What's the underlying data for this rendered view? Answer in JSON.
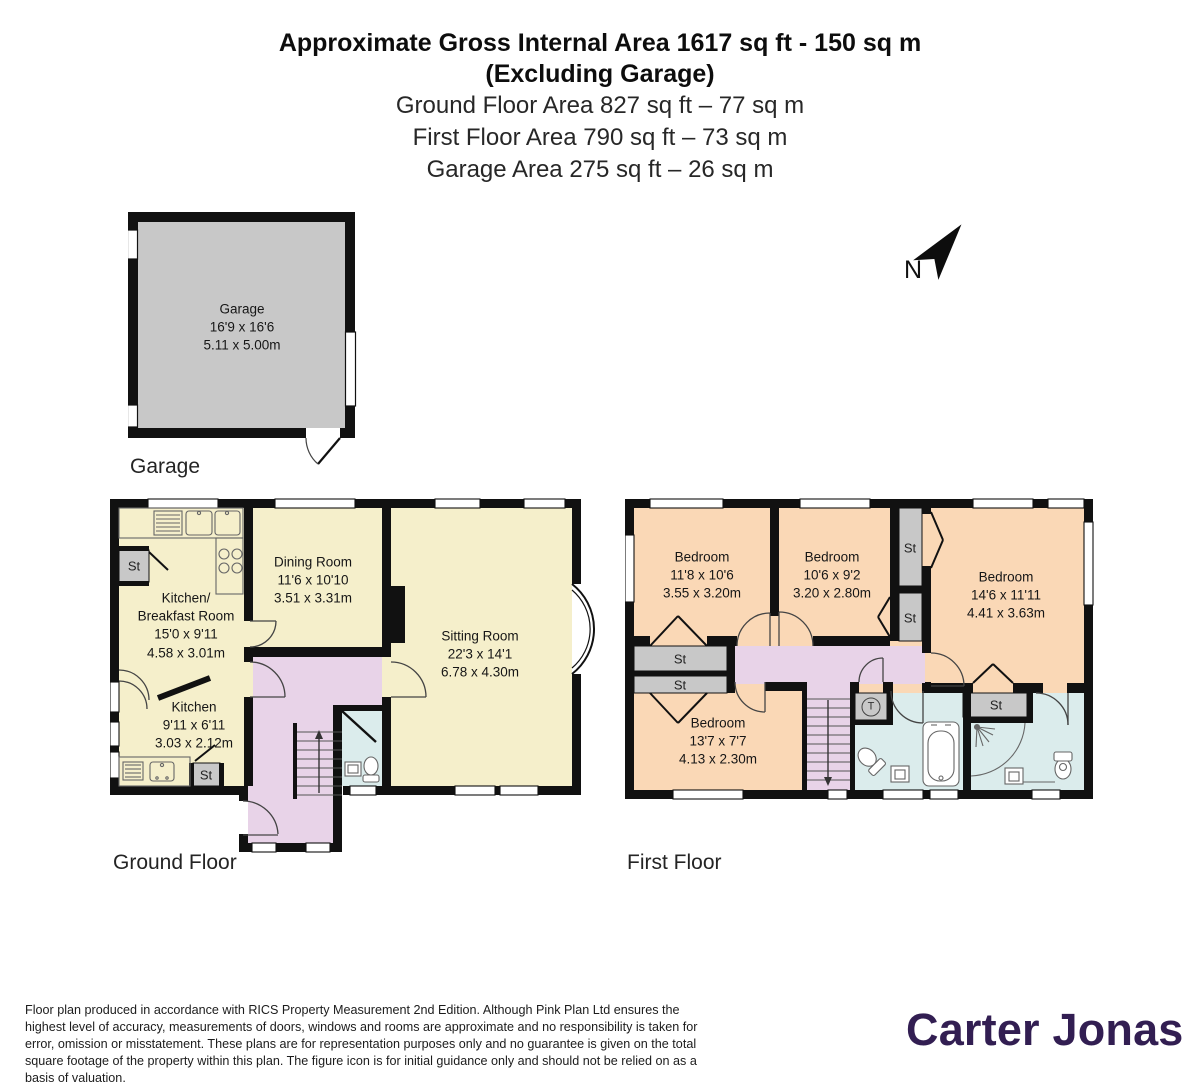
{
  "header": {
    "title_line1": "Approximate Gross Internal Area 1617 sq ft - 150 sq m",
    "title_line2": "(Excluding Garage)",
    "subtitle_lines": [
      "Ground Floor Area 827 sq ft – 77 sq m",
      "First Floor Area 790 sq ft – 73 sq m",
      "Garage Area 275 sq ft – 26 sq m"
    ]
  },
  "compass": {
    "label": "N"
  },
  "labels": {
    "storage": "St",
    "tank": "T"
  },
  "garage_plan": {
    "caption": "Garage",
    "room": {
      "name": "Garage",
      "imperial": "16'9 x 16'6",
      "metric": "5.11 x 5.00m"
    }
  },
  "ground_floor": {
    "caption": "Ground Floor",
    "rooms": {
      "kitchen_breakfast": {
        "name": "Kitchen/",
        "name2": "Breakfast Room",
        "imperial": "15'0 x 9'11",
        "metric": "4.58 x 3.01m"
      },
      "dining": {
        "name": "Dining Room",
        "imperial": "11'6 x 10'10",
        "metric": "3.51 x 3.31m"
      },
      "sitting": {
        "name": "Sitting Room",
        "imperial": "22'3 x 14'1",
        "metric": "6.78 x 4.30m"
      },
      "kitchen": {
        "name": "Kitchen",
        "imperial": "9'11 x 6'11",
        "metric": "3.03 x 2.12m"
      }
    }
  },
  "first_floor": {
    "caption": "First Floor",
    "rooms": {
      "bedroom1": {
        "name": "Bedroom",
        "imperial": "11'8 x 10'6",
        "metric": "3.55 x 3.20m"
      },
      "bedroom2": {
        "name": "Bedroom",
        "imperial": "10'6 x 9'2",
        "metric": "3.20 x 2.80m"
      },
      "bedroom3": {
        "name": "Bedroom",
        "imperial": "14'6 x 11'11",
        "metric": "4.41 x 3.63m"
      },
      "bedroom4": {
        "name": "Bedroom",
        "imperial": "13'7 x 7'7",
        "metric": "4.13 x 2.30m"
      }
    }
  },
  "footer": {
    "disclaimer": "Floor plan produced in accordance with RICS Property Measurement 2nd Edition. Although Pink Plan Ltd ensures the highest level of accuracy, measurements of doors, windows and rooms are approximate and no responsibility is taken for error, omission or misstatement. These plans are for representation purposes only and no guarantee is given on the total square footage of the property within this plan. The figure icon is for initial guidance only and should not be relied on as a basis of valuation.",
    "brand": "Carter Jonas"
  },
  "colors": {
    "room_yellow": "#f5efcb",
    "room_peach": "#fad8b6",
    "hall_pink": "#e8d3e8",
    "bath_blue": "#dbecec",
    "storage_gray": "#c8c8c8",
    "wall_black": "#111111",
    "brand_purple": "#321e52"
  }
}
